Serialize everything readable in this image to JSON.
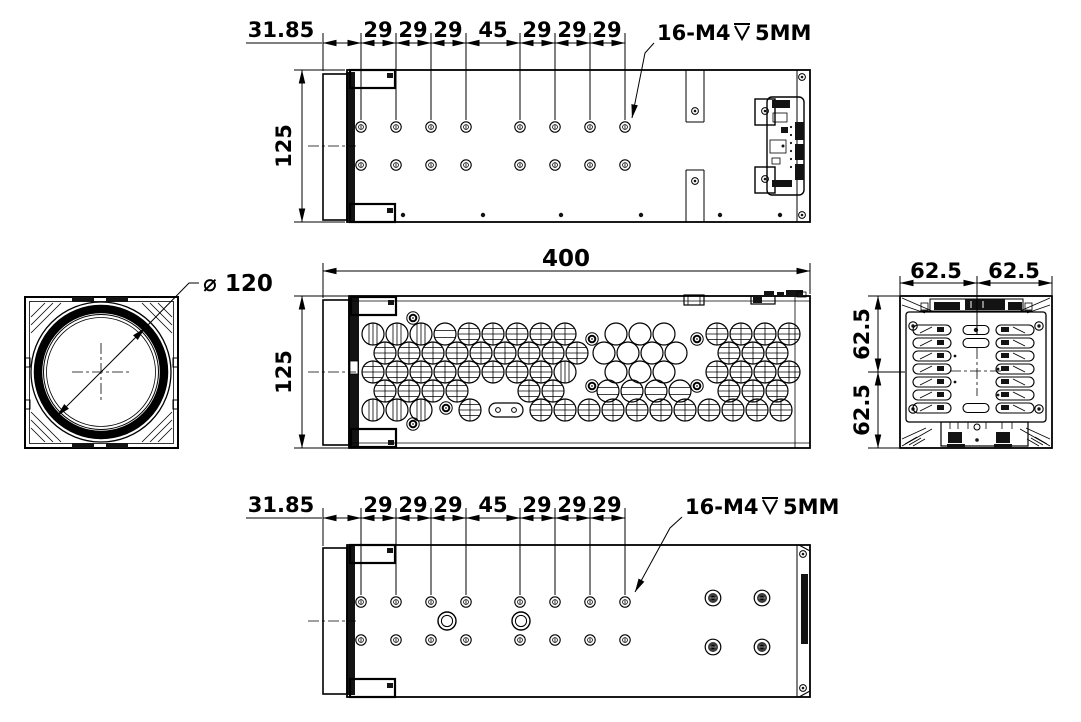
{
  "colors": {
    "ink": "#000000",
    "paper": "#ffffff"
  },
  "top_view": {
    "chain_dims": [
      "31.85",
      "29",
      "29",
      "29",
      "45",
      "29",
      "29",
      "29"
    ],
    "height_dim": "125",
    "callout": {
      "prefix": "16-M4",
      "suffix": "5MM",
      "symbol": "depth"
    }
  },
  "front_view": {
    "diameter_dim": "⌀ 120"
  },
  "side_view": {
    "length_dim": "400",
    "height_dim": "125"
  },
  "rear_view": {
    "width_dims": [
      "62.5",
      "62.5"
    ],
    "height_dims": [
      "62.5",
      "62.5"
    ]
  },
  "bottom_view": {
    "chain_dims": [
      "31.85",
      "29",
      "29",
      "29",
      "45",
      "29",
      "29",
      "29"
    ],
    "callout": {
      "prefix": "16-M4",
      "suffix": "5MM",
      "symbol": "depth"
    }
  }
}
